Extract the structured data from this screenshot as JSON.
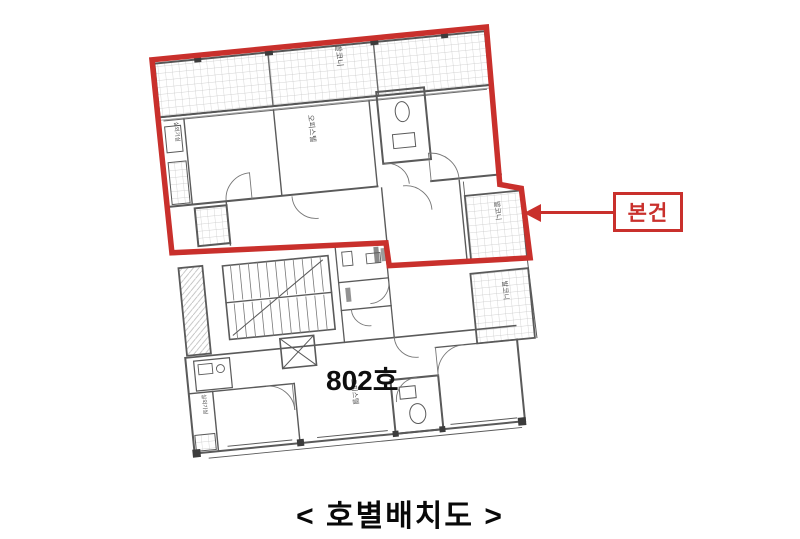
{
  "figure": {
    "caption": "< 호별배치도 >",
    "unit_label": "802호",
    "callout_label": "본건",
    "labels": {
      "balcony_top": "발코니",
      "balcony_mid": "발코니",
      "balcony_low": "발코니",
      "room_upper": "오피스텔",
      "room_lower": "오피스텔",
      "utility_upper": "실외기실",
      "utility_lower": "실외기실"
    },
    "colors": {
      "highlight": "#c9302c",
      "wall": "#5a5a5a",
      "hatch": "#c6c6c6"
    }
  }
}
